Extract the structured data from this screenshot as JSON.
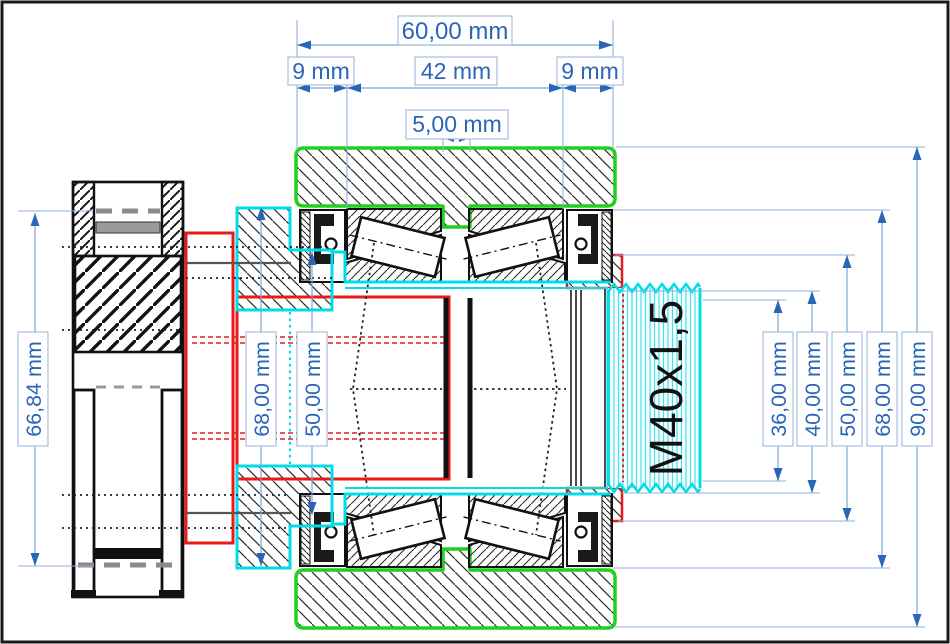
{
  "title": "bearing-assembly-technical-drawing",
  "colors": {
    "dimension_text": "#2a66b8",
    "dimension_line": "#7da7d9",
    "housing_outline_green": "#1fd11f",
    "shaft_outline_cyan": "#00dde8",
    "spindle_outline_red": "#e81a1a",
    "drawing_black": "#111111"
  },
  "labels": {
    "overall_width": "60,00 mm",
    "left_section_width": "9 mm",
    "center_section_width": "42 mm",
    "right_section_width": "9 mm",
    "rib_width": "5,00 mm",
    "pulley_diameter": "66,84 mm",
    "left_diameter_outer": "68,00 mm",
    "left_diameter_bore": "50,00 mm",
    "thread_designation": "M40x1,5",
    "right_diameter_1": "36,00 mm",
    "right_diameter_2": "40,00 mm",
    "right_diameter_3": "50,00 mm",
    "right_diameter_4": "68,00 mm",
    "right_diameter_5": "90,00 mm"
  }
}
